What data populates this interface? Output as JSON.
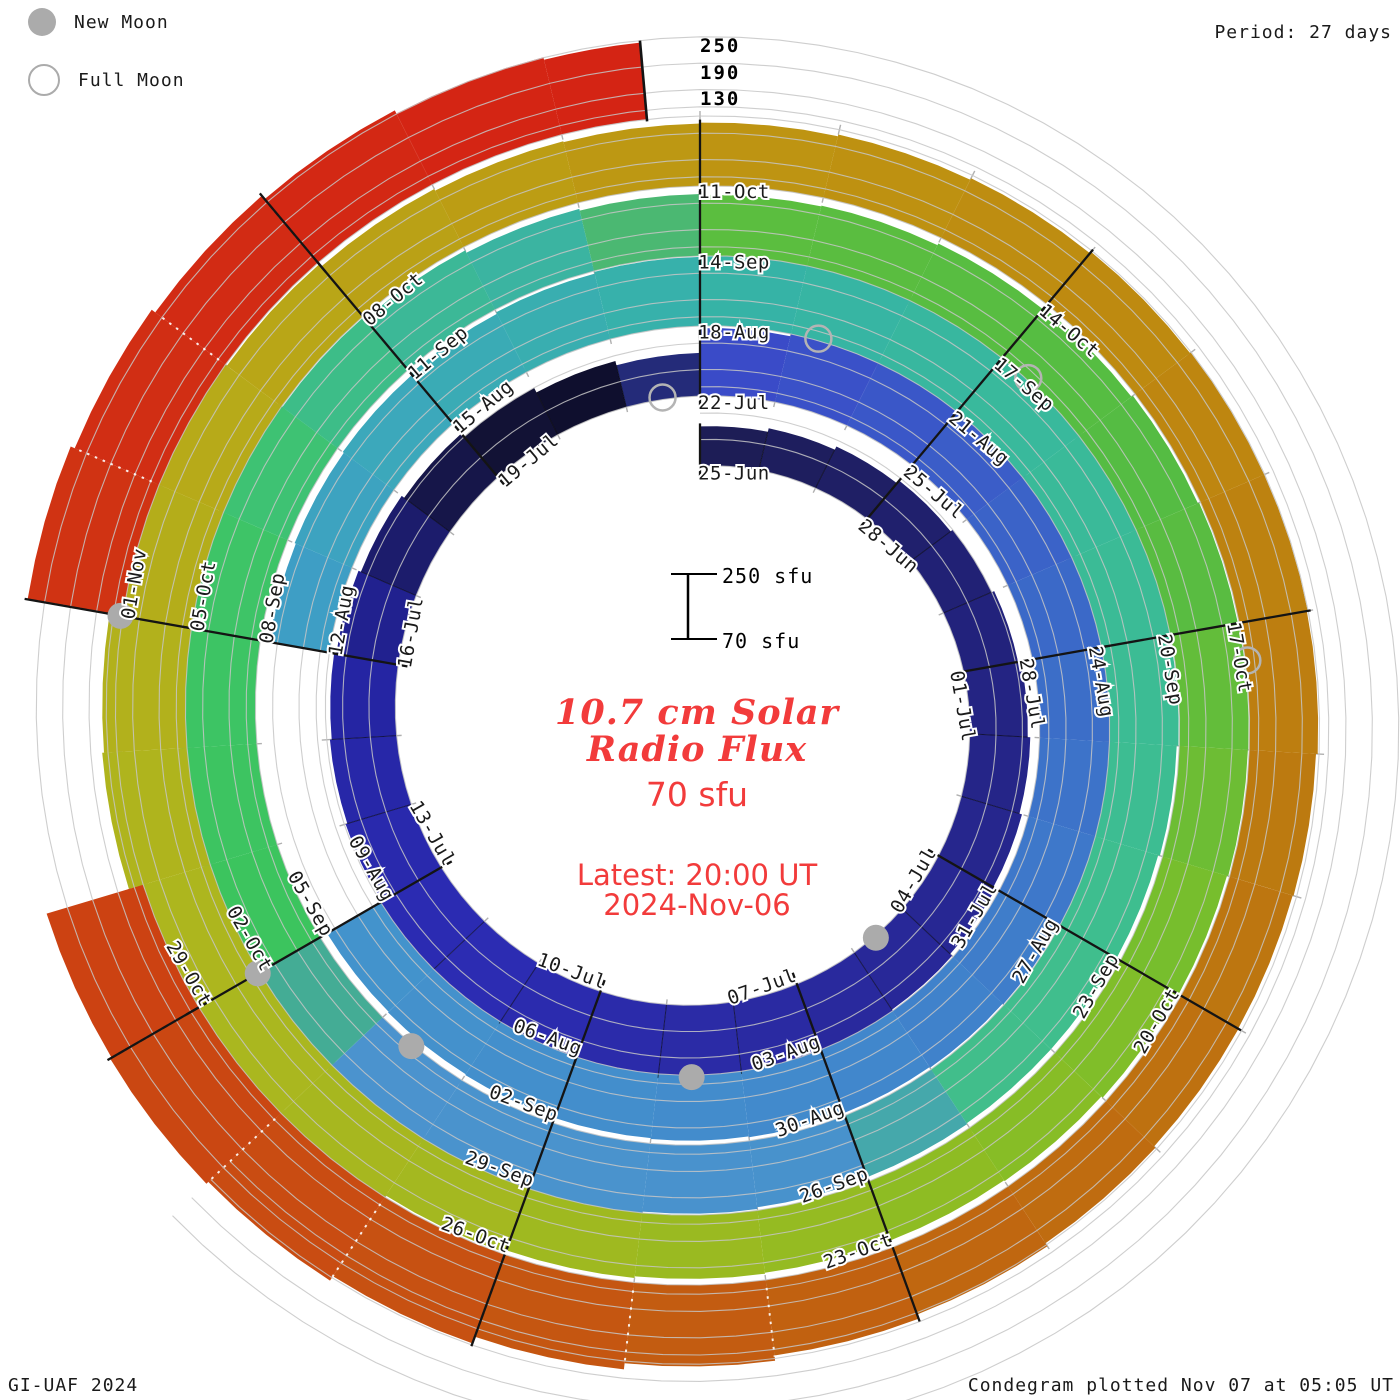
{
  "header": {
    "legend_new": "New Moon",
    "legend_full": "Full Moon",
    "period": "Period: 27 days"
  },
  "axis": {
    "top_ticks": [
      "250",
      "190",
      "130"
    ]
  },
  "scalebar": {
    "top": "250 sfu",
    "bottom": "70 sfu"
  },
  "center": {
    "title1": "10.7 cm Solar",
    "title2": "Radio Flux",
    "flux": "70 sfu",
    "latest1": "Latest: 20:00 UT",
    "latest2": "2024-Nov-06"
  },
  "footer": {
    "left": "GI-UAF 2024",
    "right": "Condegram plotted Nov 07 at 05:05 UT"
  },
  "chart_data": {
    "type": "spiral-bar (condegram)",
    "title": "10.7 cm Solar Radio Flux",
    "units": "sfu",
    "period_days": 27,
    "baseline_sfu": 70,
    "gridlines_sfu": [
      70,
      130,
      190,
      250
    ],
    "radial_axis_tick_labels": [
      "250",
      "190",
      "130"
    ],
    "start_date": "25-Jun-2024",
    "end_date": "06-Nov-2024",
    "latest_time": "20:00 UT 2024-Nov-06",
    "days_per_label": 3,
    "date_labels": [
      "25-Jun",
      "28-Jun",
      "01-Jul",
      "04-Jul",
      "07-Jul",
      "10-Jul",
      "13-Jul",
      "16-Jul",
      "19-Jul",
      "22-Jul",
      "25-Jul",
      "28-Jul",
      "31-Jul",
      "03-Aug",
      "06-Aug",
      "09-Aug",
      "12-Aug",
      "15-Aug",
      "18-Aug",
      "21-Aug",
      "24-Aug",
      "27-Aug",
      "30-Aug",
      "02-Sep",
      "05-Sep",
      "08-Sep",
      "11-Sep",
      "14-Sep",
      "17-Sep",
      "20-Sep",
      "23-Sep",
      "26-Sep",
      "29-Sep",
      "02-Oct",
      "05-Oct",
      "08-Oct",
      "11-Oct",
      "14-Oct",
      "17-Oct",
      "20-Oct",
      "23-Oct",
      "26-Oct",
      "29-Oct",
      "01-Nov"
    ],
    "flux_sfu": [
      160,
      168,
      176,
      184,
      190,
      196,
      202,
      208,
      214,
      220,
      226,
      231,
      235,
      238,
      239,
      237,
      234,
      230,
      226,
      222,
      218,
      213,
      207,
      200,
      190,
      178,
      168,
      224,
      229,
      233,
      236,
      237,
      236,
      234,
      231,
      229,
      227,
      225,
      223,
      221,
      219,
      217,
      215,
      213,
      211,
      null,
      null,
      null,
      209,
      212,
      215,
      219,
      223,
      227,
      231,
      234,
      236,
      236,
      234,
      231,
      227,
      223,
      219,
      217,
      217,
      219,
      222,
      226,
      231,
      236,
      240,
      243,
      245,
      246,
      244,
      240,
      234,
      227,
      221,
      215,
      211,
      209,
      211,
      215,
      219,
      223,
      226,
      227,
      226,
      223,
      219,
      215,
      213,
      213,
      215,
      219,
      225,
      233,
      243,
      255,
      263,
      259,
      247,
      235,
      225,
      218,
      214,
      212,
      214,
      218,
      222,
      226,
      228,
      228,
      226,
      222,
      220,
      221,
      225,
      233,
      243,
      255,
      269,
      285,
      297,
      303,
      299,
      null,
      null,
      289,
      279,
      269,
      259,
      251,
      245
    ],
    "missing_days": [
      "09-Aug",
      "10-Aug",
      "11-Aug",
      "30-Oct",
      "31-Oct"
    ],
    "color_stops": [
      [
        0,
        "#1C1C52"
      ],
      [
        6,
        "#232380"
      ],
      [
        12,
        "#2A2AA0"
      ],
      [
        17,
        "#2C2CB4"
      ],
      [
        21,
        "#2424A0"
      ],
      [
        24,
        "#131338"
      ],
      [
        26,
        "#0D0D2A"
      ],
      [
        27,
        "#3A48C8"
      ],
      [
        33,
        "#3B6CC8"
      ],
      [
        39,
        "#4289CC"
      ],
      [
        44,
        "#4492CC"
      ],
      [
        48,
        "#3F9CC8"
      ],
      [
        51,
        "#3BAAB8"
      ],
      [
        54,
        "#36B2A8"
      ],
      [
        58,
        "#39BA9A"
      ],
      [
        63,
        "#3FBE8E"
      ],
      [
        65,
        "#42BE8A"
      ],
      [
        66,
        "#4892CC"
      ],
      [
        71,
        "#4B93CE"
      ],
      [
        72,
        "#3CC45C"
      ],
      [
        76,
        "#3EC468"
      ],
      [
        78,
        "#3CBA92"
      ],
      [
        80,
        "#3AB2A6"
      ],
      [
        81,
        "#5CBE3E"
      ],
      [
        86,
        "#54BC44"
      ],
      [
        90,
        "#7CBE2A"
      ],
      [
        93,
        "#92BC22"
      ],
      [
        96,
        "#A2B820"
      ],
      [
        100,
        "#AEB61E"
      ],
      [
        104,
        "#B8A818"
      ],
      [
        108,
        "#BE9612"
      ],
      [
        112,
        "#BE8810"
      ],
      [
        116,
        "#BC7810"
      ],
      [
        120,
        "#C06410"
      ],
      [
        124,
        "#C84E12"
      ],
      [
        128,
        "#CE3A12"
      ],
      [
        131,
        "#D22C14"
      ],
      [
        134,
        "#D42414"
      ]
    ],
    "new_moon_days": [
      10.6,
      40.6,
      70.6,
      99.0,
      129.0
    ],
    "new_moon_dates": [
      "05-Jul",
      "04-Aug",
      "03-Sep",
      "02-Oct",
      "01-Nov"
    ],
    "full_moon_days": [
      26.5,
      55.3,
      84.3,
      114.3
    ],
    "full_moon_dates": [
      "21-Jul",
      "19-Aug",
      "17-Sep",
      "17-Oct"
    ],
    "last_day_fraction": 0.62,
    "marker_color": "#ababab",
    "accent_red": "#f23b3b",
    "gridline_color": "#c5c5c5"
  }
}
